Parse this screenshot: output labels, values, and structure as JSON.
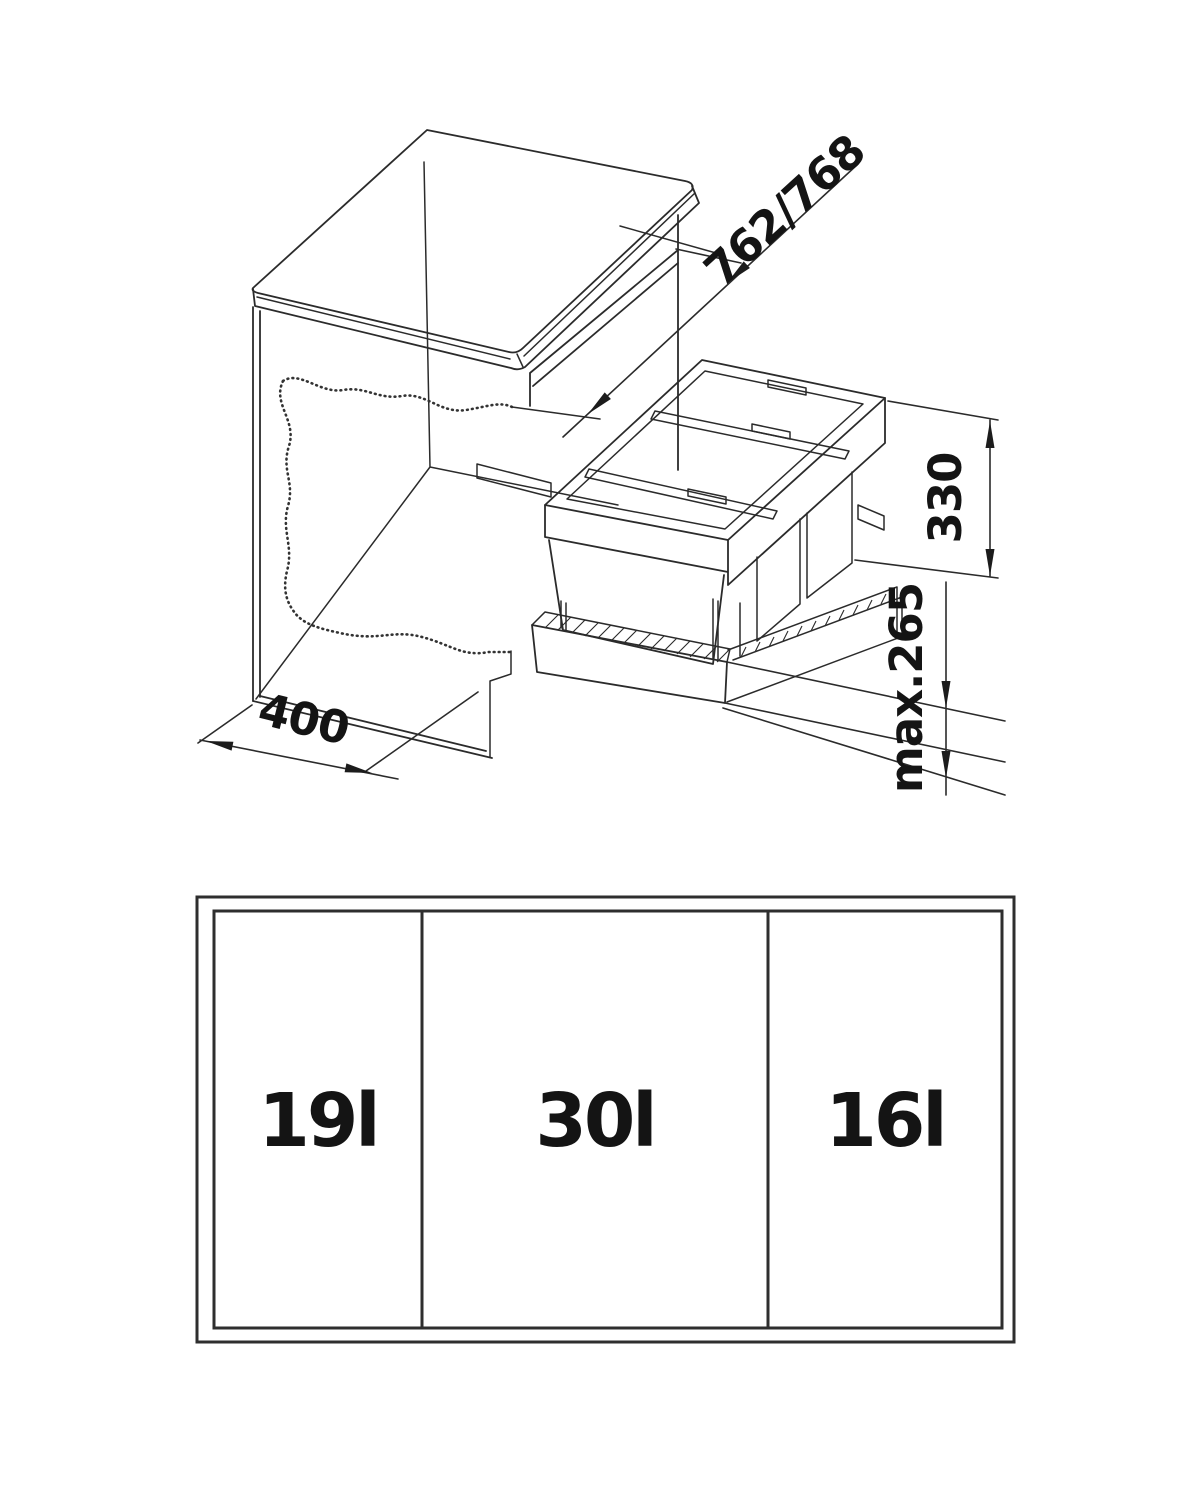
{
  "page": {
    "background": "#ffffff"
  },
  "drawing": {
    "line_color": "#2b2b2b",
    "text_color": "#141414",
    "dimension_labels": {
      "niche_width": "762/768",
      "unit_height": "330",
      "front_max": "max.265",
      "cabinet_width": "400"
    },
    "front_view_labels": {
      "left": "19l",
      "middle": "30l",
      "right": "16l"
    }
  }
}
